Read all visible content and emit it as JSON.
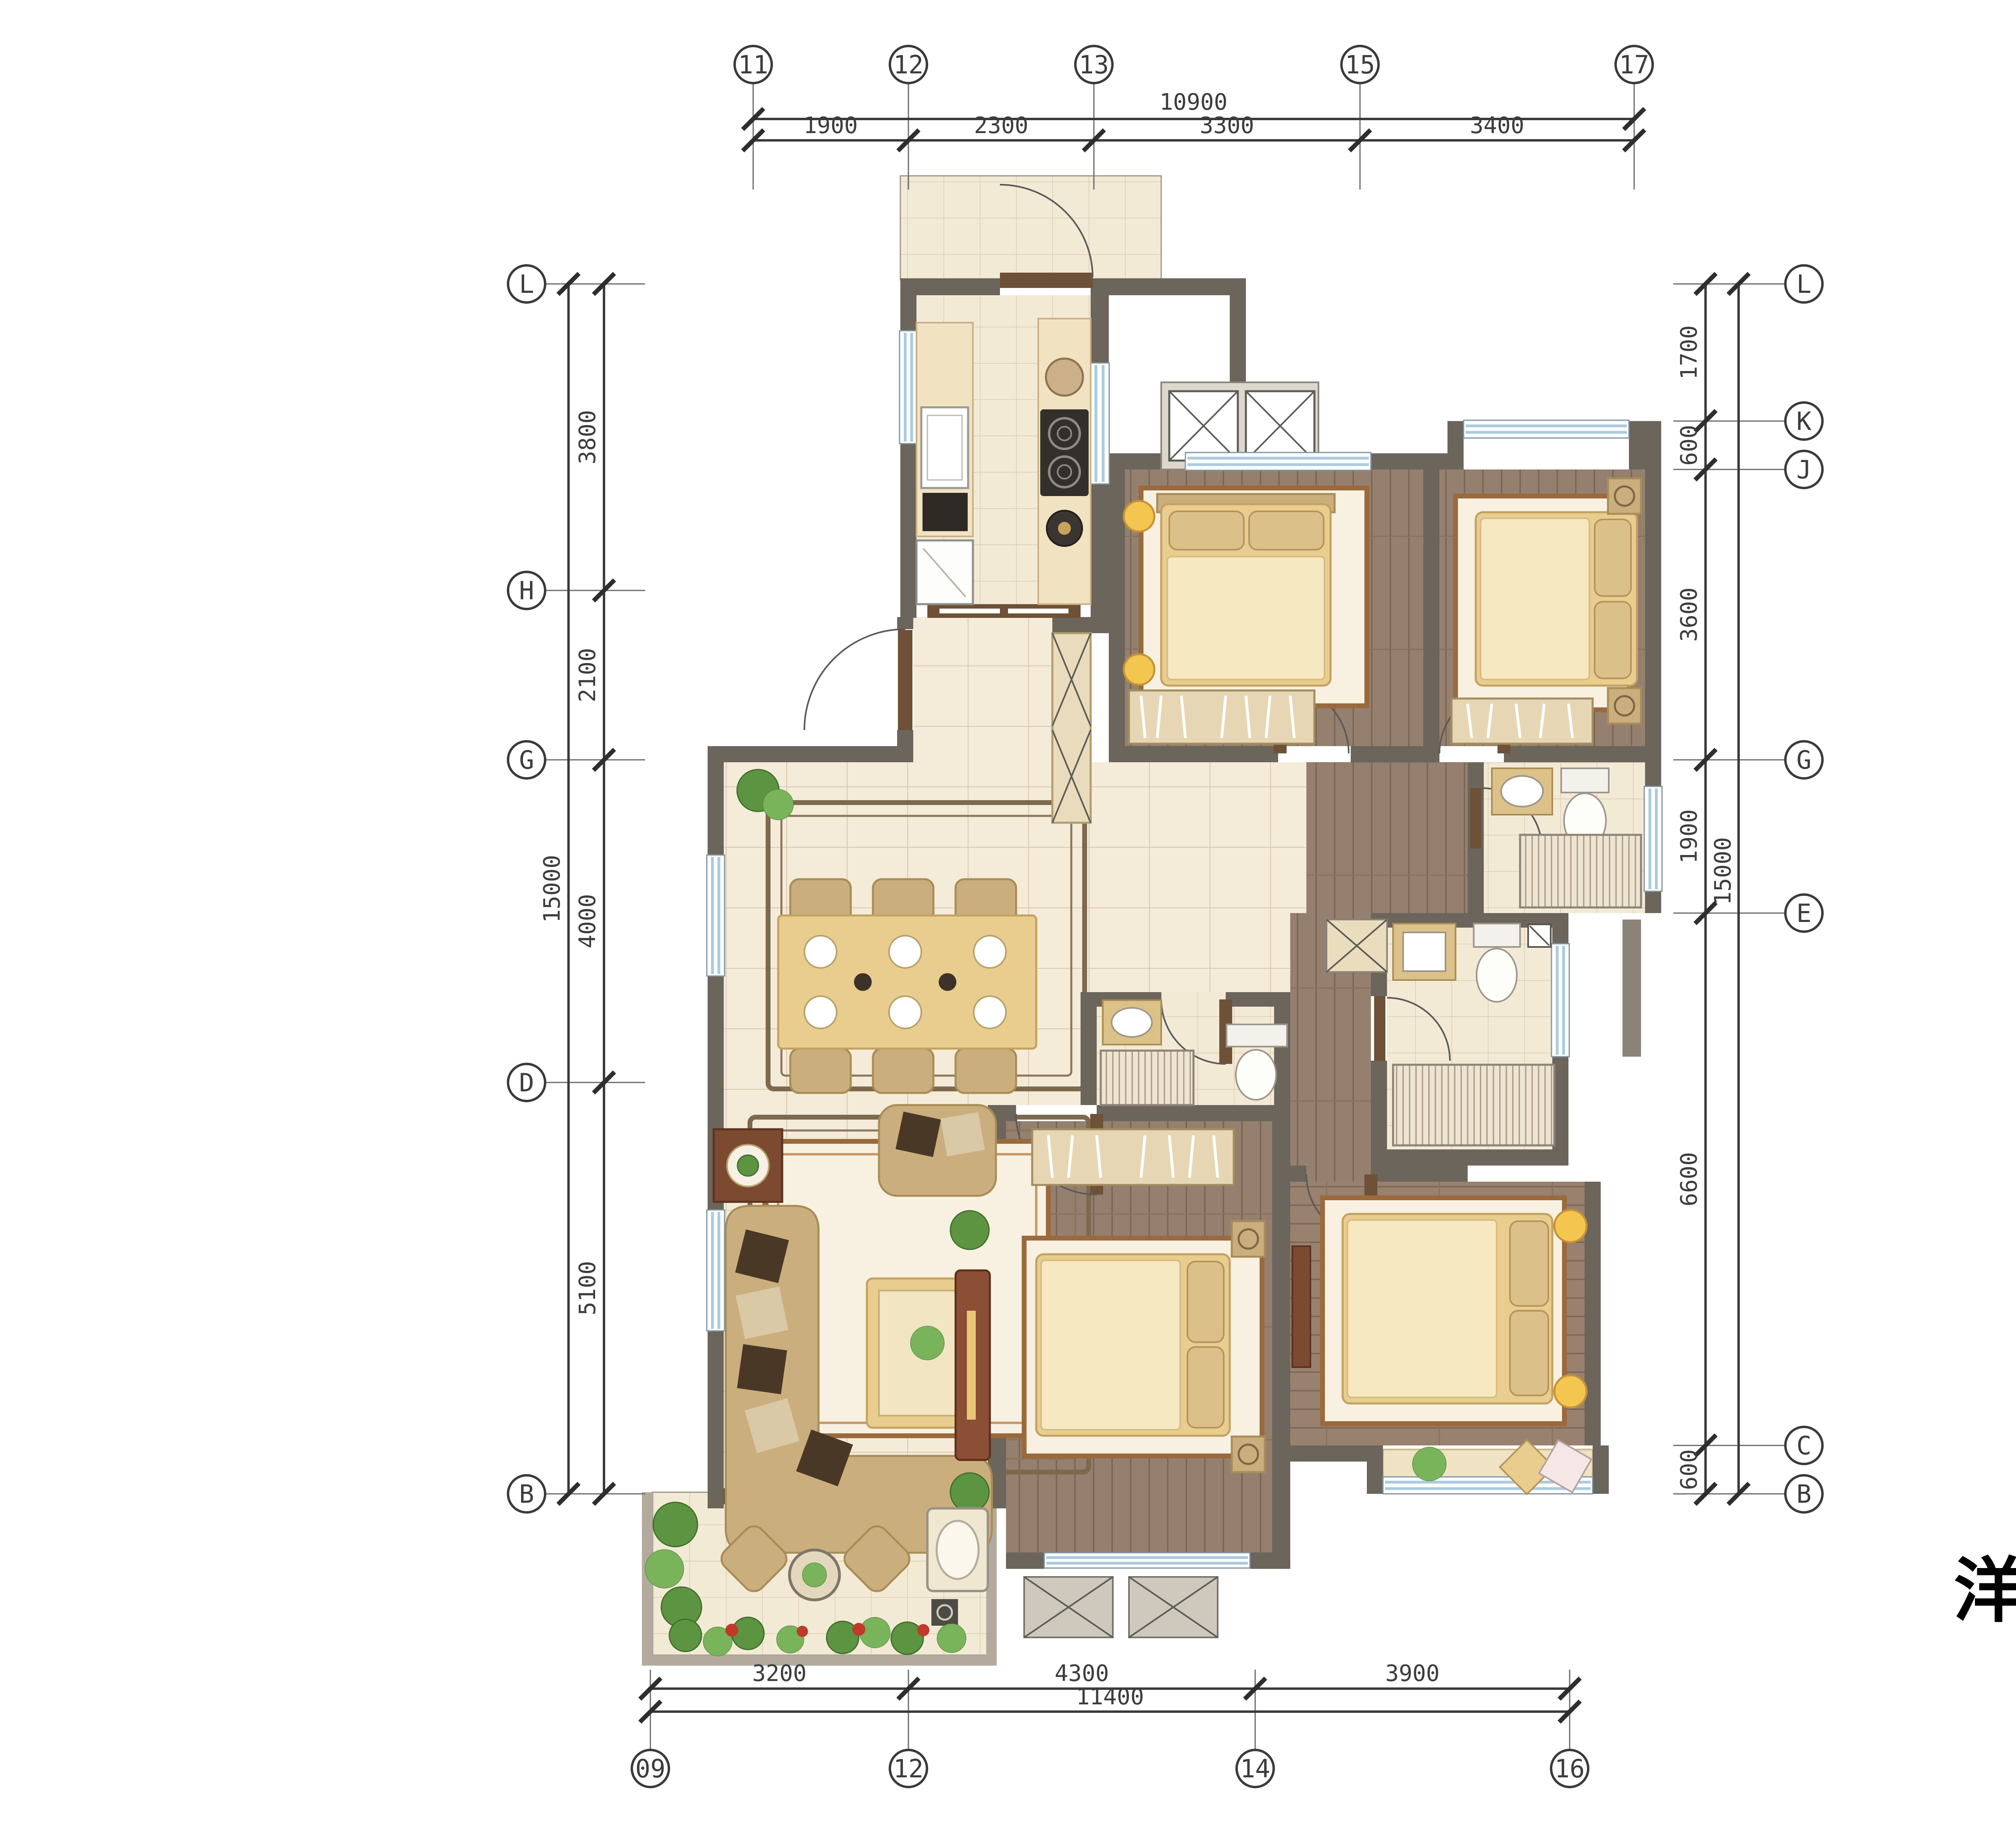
{
  "title": "洋房A1",
  "grid_axes": {
    "top": [
      "11",
      "12",
      "13",
      "15",
      "17"
    ],
    "bottom": [
      "09",
      "12",
      "14",
      "16"
    ],
    "left": [
      "L",
      "H",
      "G",
      "D",
      "B"
    ],
    "right": [
      "L",
      "K",
      "J",
      "G",
      "E",
      "C",
      "B"
    ]
  },
  "dimensions": {
    "top": {
      "overall": "10900",
      "segments": [
        "1900",
        "2300",
        "3300",
        "3400"
      ]
    },
    "bottom": {
      "overall": "11400",
      "segments": [
        "3200",
        "4300",
        "3900"
      ]
    },
    "left": {
      "overall": "15000",
      "segments": [
        "3800",
        "2100",
        "4000",
        "5100"
      ]
    },
    "right": {
      "overall": "15000",
      "segments": [
        "1700",
        "600",
        "3600",
        "1900",
        "6600",
        "600"
      ]
    }
  },
  "colors": {
    "wall_dark": "#6b655b",
    "wall_light": "#b3aa9d",
    "floor_tile": "#f4ebd9",
    "floor_wood": "#95806f",
    "window_glass": "#a9cbde",
    "furniture_gold": "#e8cd8e",
    "sofa_tan": "#cbae7d",
    "console_brown": "#8a4f35",
    "plant_green": "#5d9441",
    "annotation": "#3a3a3a"
  }
}
